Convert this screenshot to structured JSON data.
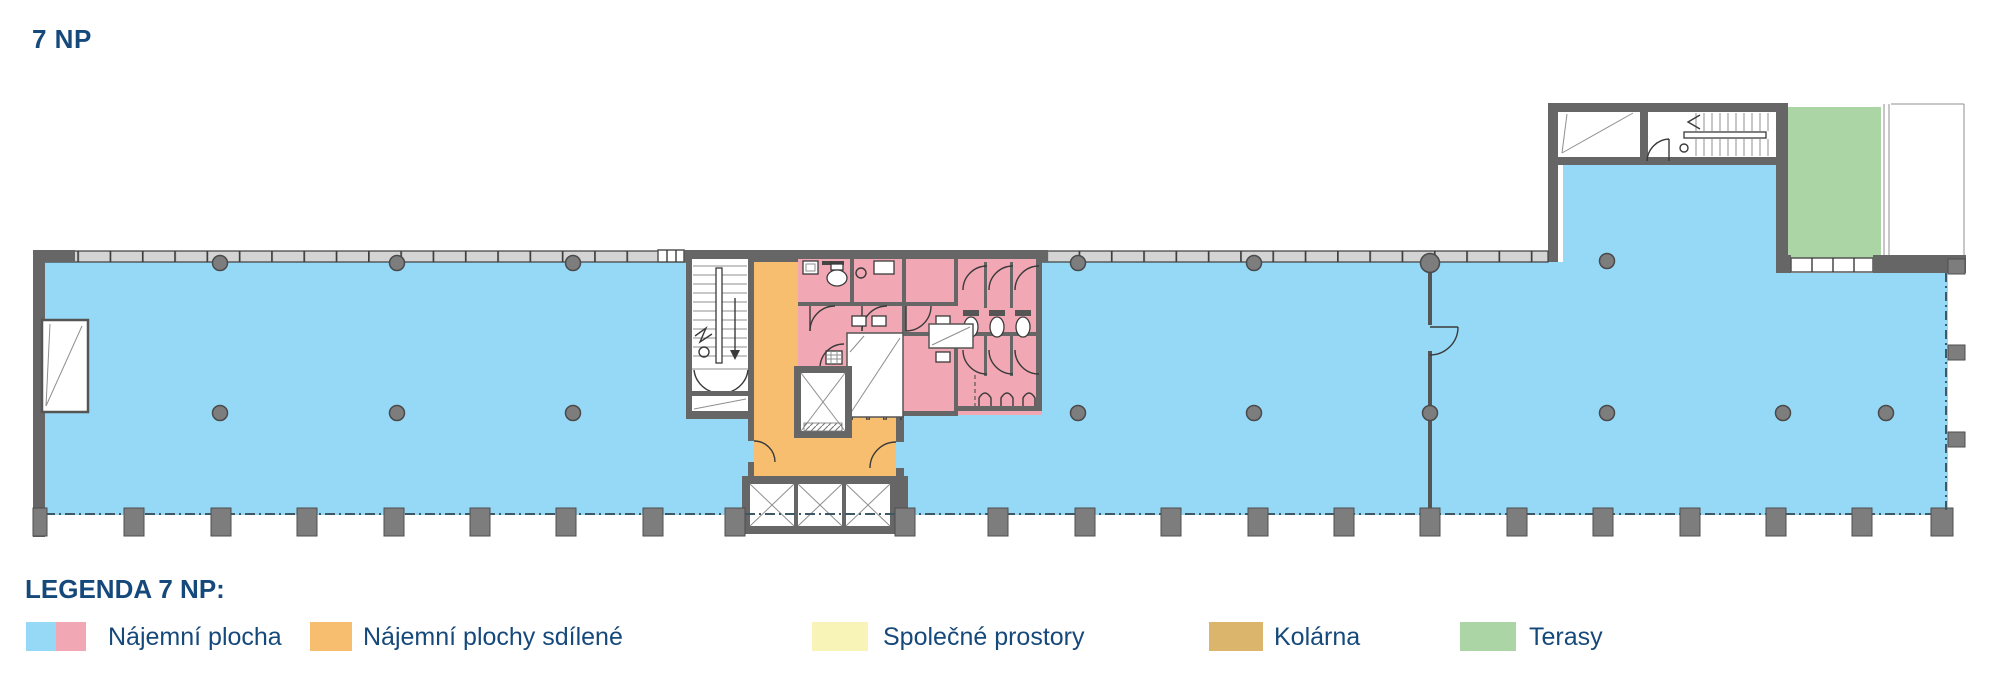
{
  "page": {
    "title": "7 NP"
  },
  "legend": {
    "title": "LEGENDA 7 NP:",
    "items": [
      {
        "label": "Nájemní plocha",
        "colors": [
          "#96D9F6",
          "#F2A8B4"
        ]
      },
      {
        "label": "Nájemní plochy sdílené",
        "colors": [
          "#F6BE6E"
        ]
      },
      {
        "label": "Společné prostory",
        "colors": [
          "#F8F4B8"
        ]
      },
      {
        "label": "Kolárna",
        "colors": [
          "#DBB56C"
        ]
      },
      {
        "label": "Terasy",
        "colors": [
          "#ACD5A5"
        ]
      }
    ]
  },
  "colors": {
    "rental_blue": "#96D9F6",
    "rental_pink": "#F2A8B4",
    "shared_orange": "#F6BE6E",
    "common_yellow": "#F8F4B8",
    "bike_tan": "#DBB56C",
    "terrace_green": "#ACD5A5",
    "wall_gray": "#666666",
    "heading_navy": "#16497B"
  }
}
